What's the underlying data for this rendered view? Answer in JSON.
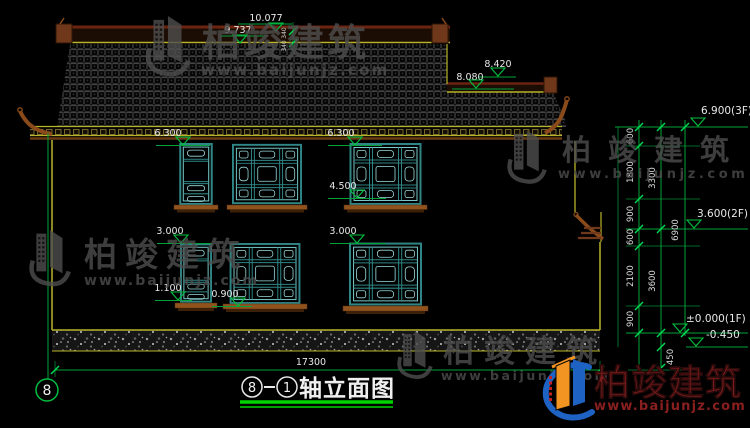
{
  "drawing": {
    "titleblock": {
      "axis_from": "8",
      "separator": "-",
      "axis_to": "1",
      "label": "轴立面图"
    },
    "axis_bubble": "8",
    "dims": {
      "ridge": "10.077",
      "ridge2": "9.737",
      "ridge_gap1": "340",
      "ridge_gap2": "340",
      "wing_ridge": "8.420",
      "wing_ridge2": "8.080",
      "eave_l": "6.300",
      "eave_r": "6.300",
      "sill2f": "4.500",
      "win1f_l": "3.000",
      "win1f_r": "3.000",
      "sill1f_l": "1.100",
      "sill1f_r": "0.900",
      "total_width": "17300"
    },
    "levels": {
      "f3": "6.900(3F)",
      "f2": "3.600(2F)",
      "f1": "±0.000(1F)",
      "base": "-0.450"
    },
    "chain": {
      "c600a": "600",
      "c1800": "1800",
      "c900a": "900",
      "c600b": "600",
      "c2100": "2100",
      "c900b": "900",
      "c3300": "3300",
      "c3600": "3600",
      "c6900": "6900",
      "c450": "450"
    }
  },
  "brand": {
    "name": "柏竣建筑",
    "url": "www.baijunjz.com"
  },
  "colors": {
    "background": "#000000",
    "dim_green": "#00a33a",
    "wall_yellow": "#b8b32a",
    "window_teal": "#2f8585",
    "roof_brown": "#8a4a1a",
    "text_white": "#e8e8e8",
    "logo_blue": "#1e62c4",
    "logo_orange": "#f29422",
    "logo_red": "#7c1c1c"
  }
}
